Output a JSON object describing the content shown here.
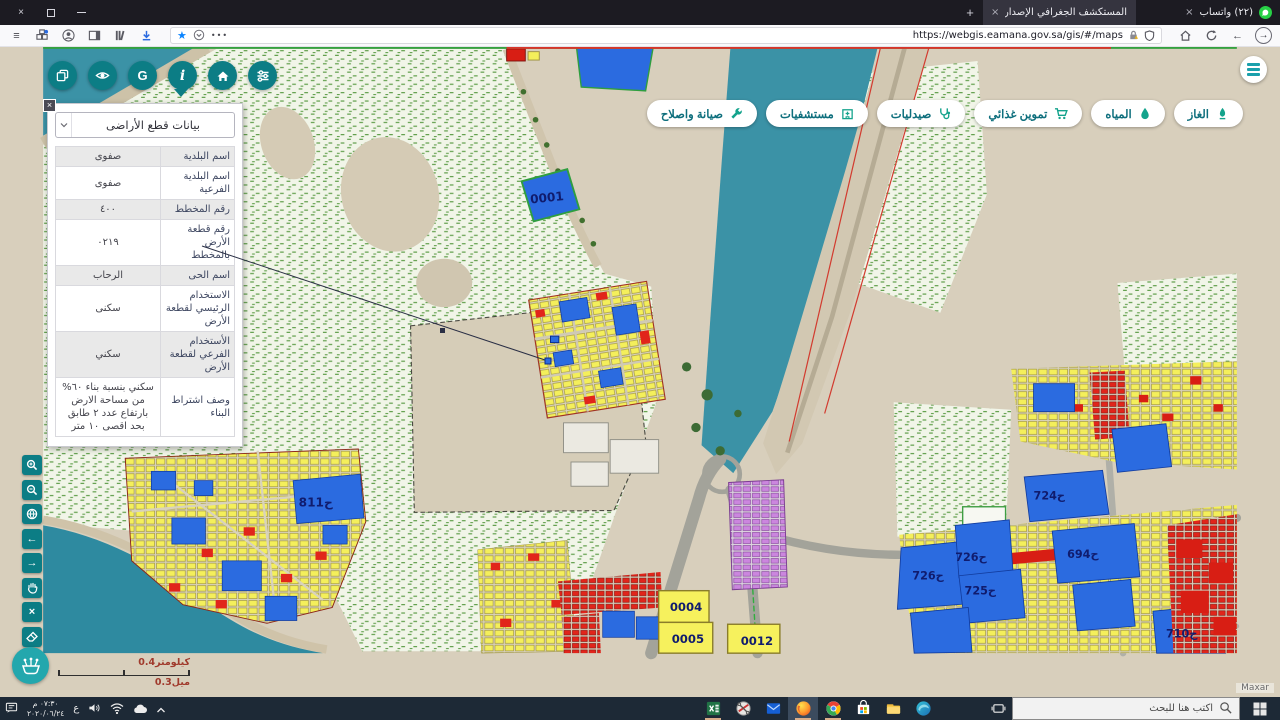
{
  "browser": {
    "tab_active": "المستكشف الجغرافي الإصدار رقم 1.1",
    "tab_whatsapp": "(٢٢) واتساب",
    "url": "https://webgis.eamana.gov.sa/gis/#/maps"
  },
  "glyphs": {
    "close": "×",
    "plus": "+",
    "menu": "≡",
    "ellipsis": "•••",
    "star": "★",
    "back": "←",
    "forward": "→",
    "left_arrow": "←",
    "right_arrow": "→",
    "x": "×",
    "g": "G",
    "i": "i"
  },
  "panel": {
    "title": "بيانات قطع الأراضى",
    "rows": [
      {
        "label": "اسم البلدية",
        "value": "صفوى"
      },
      {
        "label": "اسم البلدية الفرعية",
        "value": "صفوى"
      },
      {
        "label": "رقم المخطط",
        "value": "٤٠٠"
      },
      {
        "label": "رقم قطعة الأرض بالمخطط",
        "value": "٠٢١٩"
      },
      {
        "label": "اسم الحى",
        "value": "الرحاب"
      },
      {
        "label": "الاستخدام الرئيسي لقطعة الأرض",
        "value": "سكنى"
      },
      {
        "label": "الأستخدام الفرعي لقطعة الأرض",
        "value": "سكني"
      },
      {
        "label": "وصف اشتراط البناء",
        "value": "سكني بنسبة بناء ٦٠% من مساحة الارض بارتفاع عدد ٢ طابق بحد اقصى ١٠ متر"
      }
    ]
  },
  "services": [
    {
      "label": "الغاز"
    },
    {
      "label": "المياه"
    },
    {
      "label": "تموين غذائي"
    },
    {
      "label": "صيدليات"
    },
    {
      "label": "مستشفيات"
    },
    {
      "label": "صيانة واصلاح"
    }
  ],
  "map": {
    "labels": {
      "p0001": "0001",
      "p811": "811ح",
      "p724": "724ح",
      "p694": "694ح",
      "p726a": "726ح",
      "p726b": "726ح",
      "p725": "725ح",
      "p710": "710ح",
      "p0004": "0004",
      "p0005": "0005",
      "p0012": "0012"
    },
    "scale_km": "0.4كيلومتر",
    "scale_mi": "0.3ميل",
    "attribution": "Maxar",
    "colors": {
      "residential_yellow": "#f4ef5b",
      "public_blue": "#2b6be0",
      "commercial_red": "#e1251b",
      "mixed_purple": "#cb86de",
      "water_teal": "#3b92a6",
      "ui_teal": "#0c7d85"
    }
  },
  "taskbar": {
    "search": "اكتب هنا للبحث",
    "time": "٠٧:٣٠ م",
    "date": "٢٠٢٠/٠٦/٢٤",
    "lang": "ع"
  }
}
